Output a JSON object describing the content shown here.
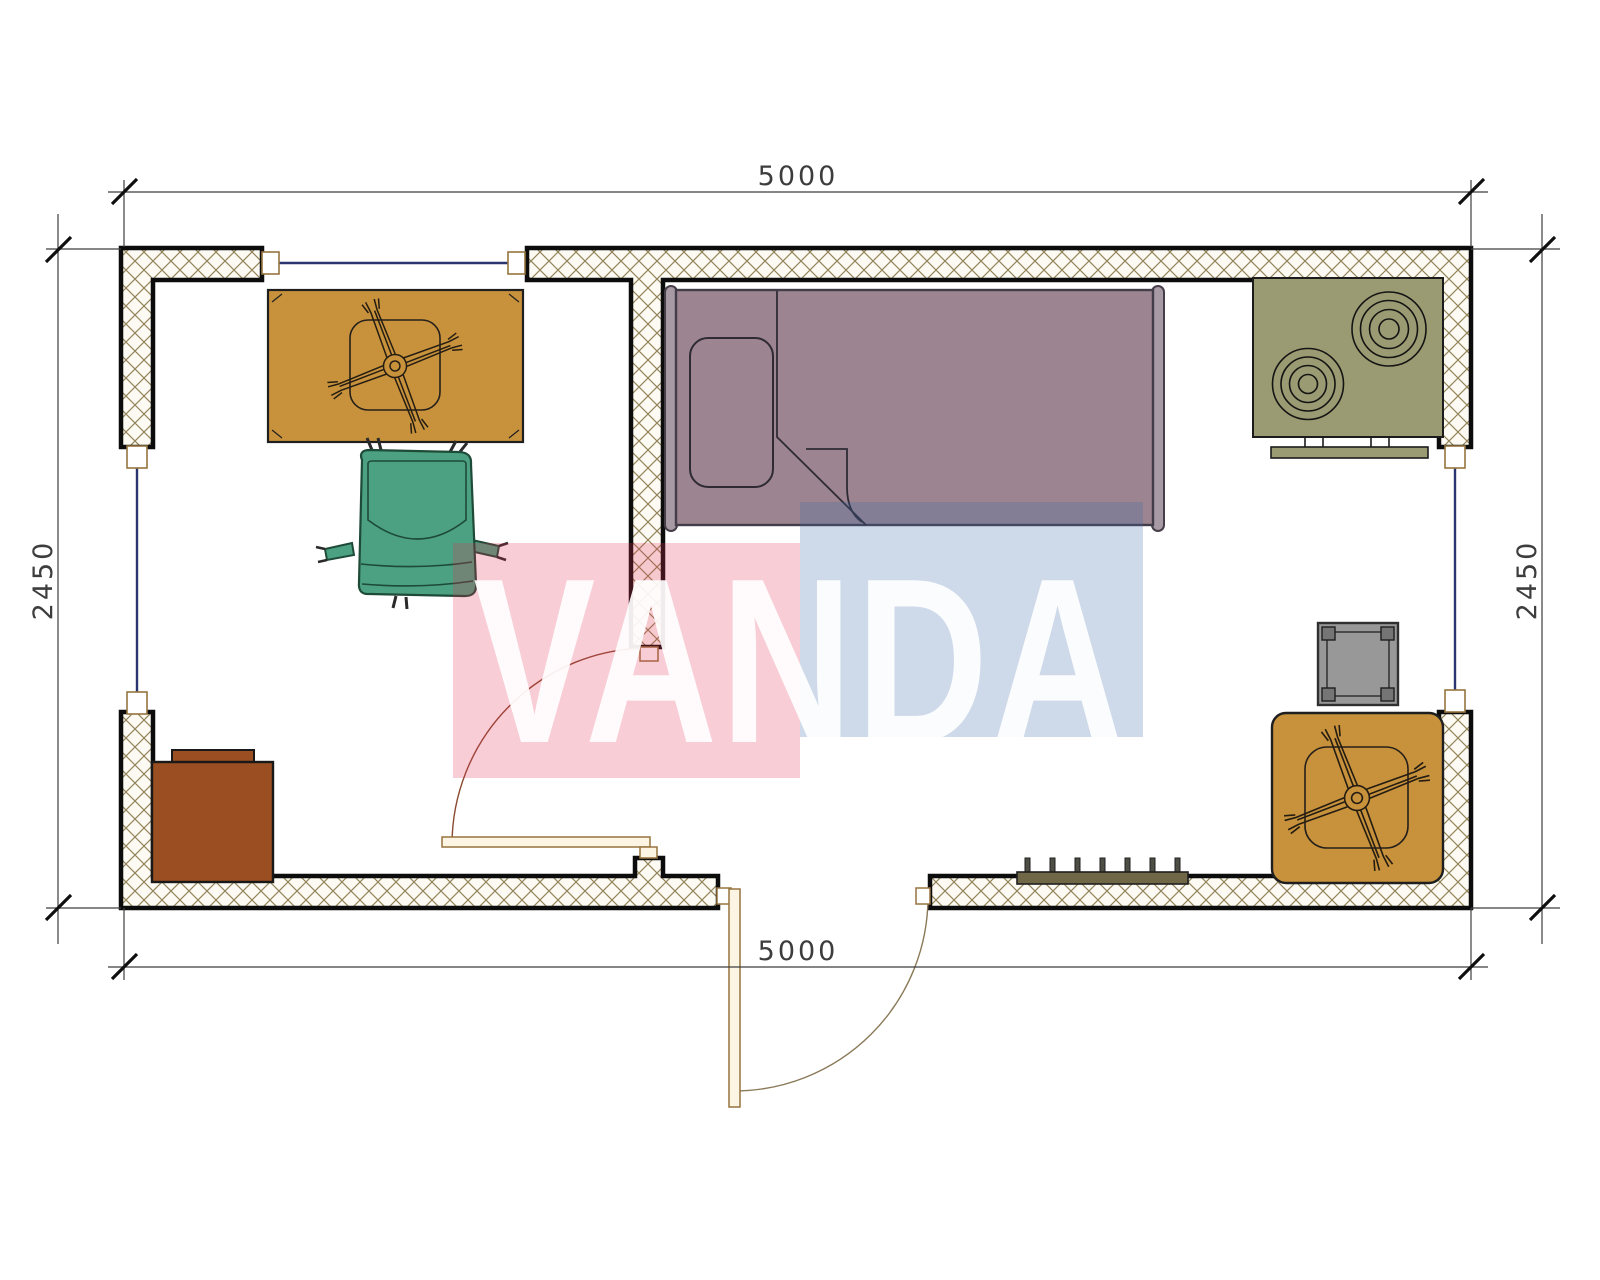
{
  "drawing": {
    "type": "architectural-floor-plan",
    "units": "mm"
  },
  "dimensions": {
    "top": {
      "label": "5000"
    },
    "bottom": {
      "label": "5000"
    },
    "left": {
      "label": "2450"
    },
    "right": {
      "label": "2450"
    }
  },
  "watermark": {
    "text": "VANDA",
    "pink_block": "rgba(226,46,82,0.24)",
    "blue_block": "rgba(66,110,170,0.26)",
    "letter_color": "rgba(255,255,255,0.92)"
  },
  "colors": {
    "wall_hatch_bg": "#fcfaf3",
    "wall_hatch_line": "#93845a",
    "wall_border": "#0c0c0c",
    "table_tan": "#c8923c",
    "chair_green": "#4ba181",
    "bed_mauve": "#9c8490",
    "bed_post": "#a79aa5",
    "stove_olive": "#9b9b73",
    "cabinet_brown": "#9a4e22",
    "side_table_gray": "#989898",
    "radiator_olive": "#6f6746",
    "window_line": "#2a3570",
    "door_leaf": "#fdf5e4",
    "dim_line": "#3d3d3d"
  },
  "furniture": [
    {
      "name": "dining-table",
      "color_key": "table_tan"
    },
    {
      "name": "office-chair",
      "color_key": "chair_green"
    },
    {
      "name": "single-bed",
      "color_key": "bed_mauve"
    },
    {
      "name": "stove-cooktop",
      "color_key": "stove_olive"
    },
    {
      "name": "cabinet",
      "color_key": "cabinet_brown"
    },
    {
      "name": "radiator",
      "color_key": "radiator_olive"
    },
    {
      "name": "side-table",
      "color_key": "side_table_gray"
    },
    {
      "name": "corner-table",
      "color_key": "table_tan"
    }
  ]
}
